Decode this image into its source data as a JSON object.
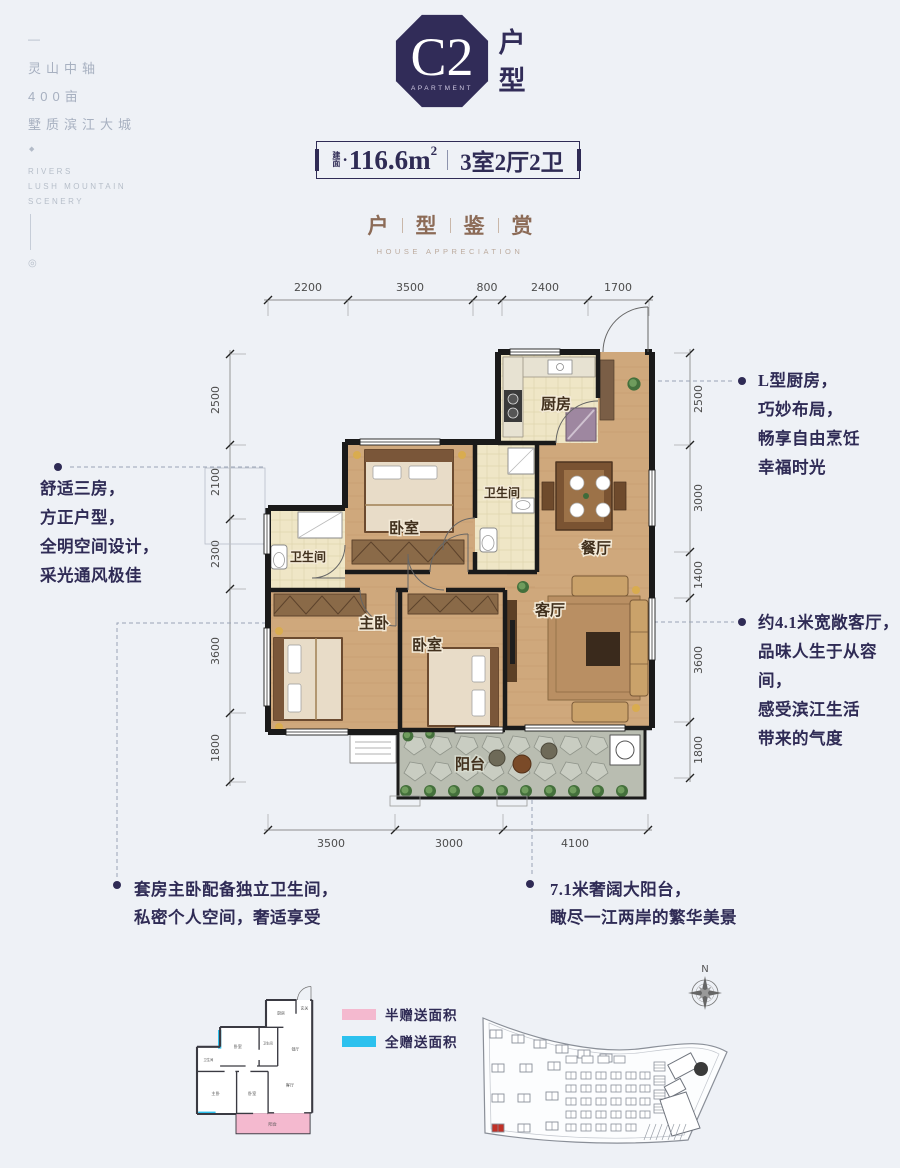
{
  "colors": {
    "navy": "#2f2b55",
    "title_brown": "#8c6b57",
    "wall": "#1a1a1a",
    "wood": "#cfa87c",
    "tile": "#efe6c6",
    "balcony": "#b9bdb1",
    "pink": "#f4b9cf",
    "cyan": "#2cc1ee",
    "highlight_building": "#c23127"
  },
  "sidebar": {
    "dash": "—",
    "cn": [
      "灵山中轴",
      "400亩",
      "墅质滨江大城"
    ],
    "diamond": "◆",
    "en": [
      "RIVERS",
      "LUSH MOUNTAIN",
      "SCENERY"
    ],
    "ring": "◎"
  },
  "logo": {
    "code": "C2",
    "sub": "APARTMENT",
    "char1": "户",
    "char2": "型"
  },
  "badge": {
    "label_top": "建",
    "label_bottom": "面",
    "dot": "•",
    "area": "116.6m",
    "sup": "2",
    "rooms": "3室2厅2卫"
  },
  "title": {
    "c1": "户",
    "c2": "型",
    "c3": "鉴",
    "c4": "赏",
    "en": "HOUSE APPRECIATION"
  },
  "plan": {
    "dims_top": [
      "2200",
      "3500",
      "800",
      "2400",
      "1700"
    ],
    "dims_left": [
      "2500",
      "2100",
      "2300",
      "3600",
      "1800"
    ],
    "dims_right": [
      "2500",
      "3000",
      "1400",
      "3600",
      "1800"
    ],
    "dims_bottom": [
      "3500",
      "3000",
      "4100"
    ],
    "rooms": {
      "kitchen": "厨房",
      "hall": "玄关",
      "bath1": "卫生间",
      "bed1": "卧室",
      "dining": "餐厅",
      "bath2": "卫生间",
      "master": "主卧",
      "bed2": "卧室",
      "living": "客厅",
      "balcony": "阳台"
    }
  },
  "annotations": {
    "left": [
      "舒适三房，",
      "方正户型，",
      "全明空间设计，",
      "采光通风极佳"
    ],
    "right_top": [
      "L型厨房，",
      "巧妙布局，",
      "畅享自由烹饪",
      "幸福时光"
    ],
    "right_mid": [
      "约4.1米宽敞客厅，",
      "品味人生于从容间，",
      "感受滨江生活",
      "带来的气度"
    ],
    "bottom_left": [
      "套房主卧配备独立卫生间，",
      "私密个人空间，奢适享受"
    ],
    "bottom_right": [
      "7.1米奢阔大阳台，",
      "瞰尽一江两岸的繁华美景"
    ]
  },
  "legend": {
    "items": [
      {
        "label": "半赠送面积",
        "color": "#f4b9cf"
      },
      {
        "label": "全赠送面积",
        "color": "#2cc1ee"
      }
    ]
  },
  "compass": {
    "n": "N"
  }
}
